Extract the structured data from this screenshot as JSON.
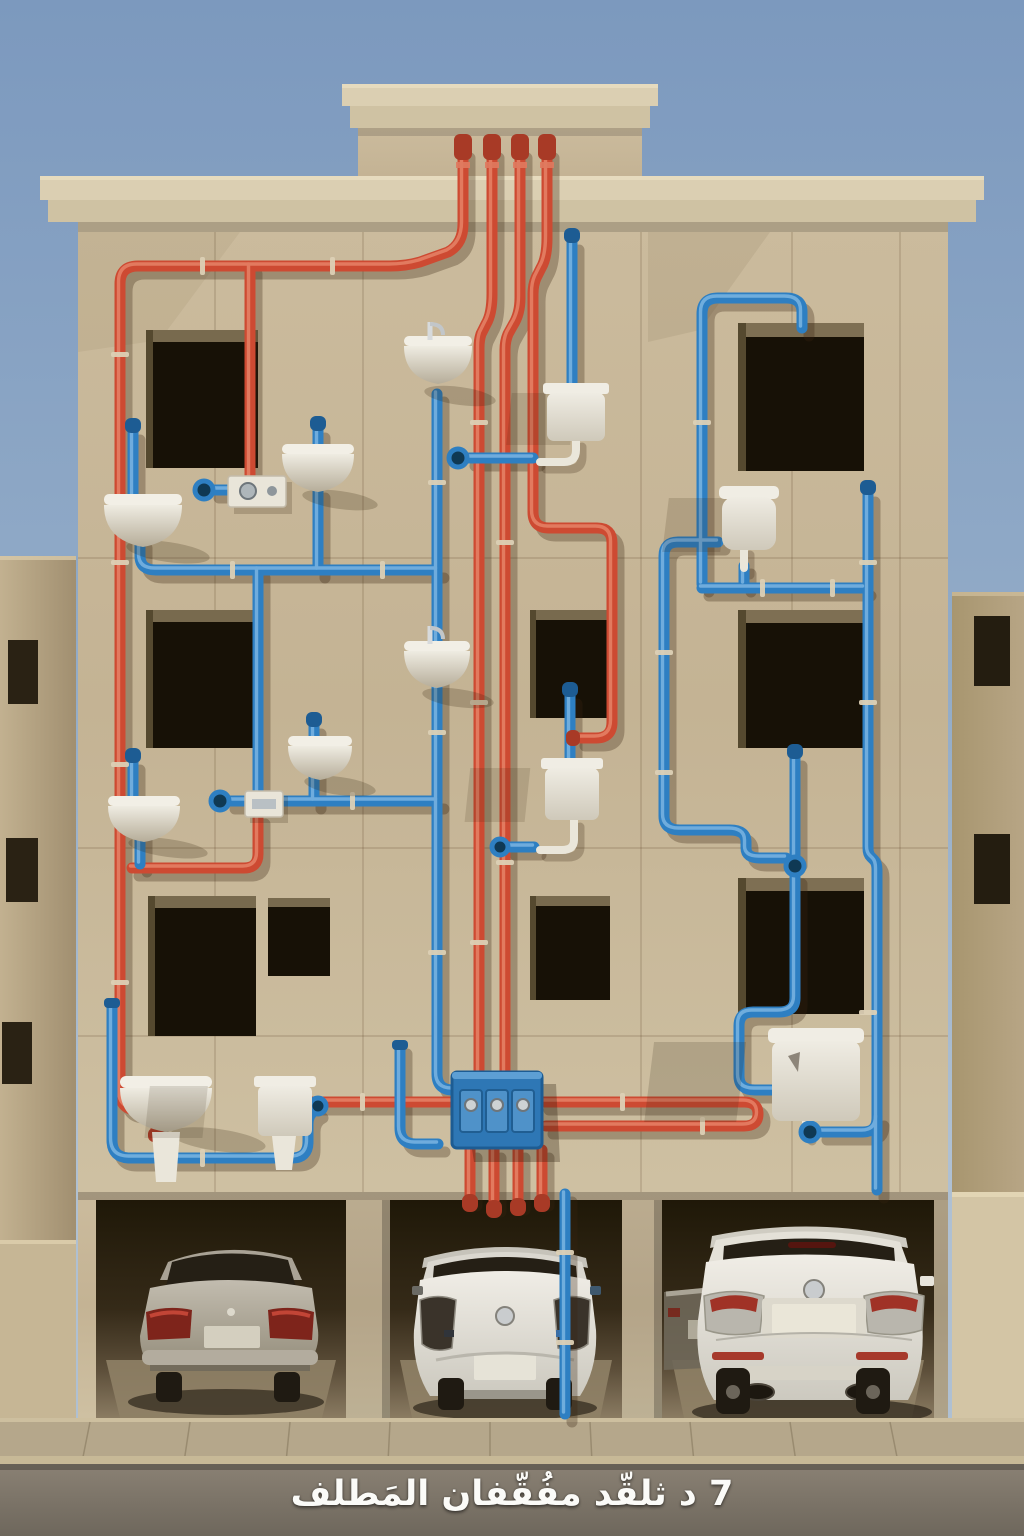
{
  "image": {
    "kind": "photorealistic building facade with exposed color-coded plumbing",
    "width": 1024,
    "height": 1536,
    "time_of_day": "clear daylight"
  },
  "caption": {
    "text": "7 د ثلقّد مفُقّفان المَطلف",
    "dir": "rtl"
  },
  "colors": {
    "sky-top": "#7C99BE",
    "sky-mid": "#93ACC8",
    "sky-bottom": "#AFC0D2",
    "facade": "#C7B797",
    "facade-light": "#D6C8AA",
    "facade-dark": "#B0A081",
    "cornice": "#DBCFB2",
    "cornice-lip": "#CFC2A3",
    "window-dark": "#171106",
    "window-reveal": "#8A7A5C",
    "pipe-hot": "#CD4A32",
    "pipe-hot-light": "#EA8A6F",
    "pipe-hot-dark": "#A83A26",
    "pipe-cold": "#2E7FC2",
    "pipe-cold-light": "#85BCE6",
    "pipe-cold-dark": "#1D5C93",
    "ceramic": "#EAE6DA",
    "ceramic-dark": "#BCB3A0",
    "clamp": "#DCD0B5",
    "manifold": "#2E77B5",
    "manifold-panel": "#4F92C9",
    "neighbor": "#B7A585",
    "neighbor-lit": "#D3C5A5",
    "bay-floor": "#8F8166",
    "sidewalk": "#B5A78B",
    "street": "#827A6D",
    "car-silver": "#B9B3A6",
    "car-white": "#EBE8E1",
    "glass": "#251F15",
    "tire": "#1F1A12",
    "taillight-red": "#A03226",
    "caption-color": "#FBFBF8"
  },
  "building": {
    "floors_above_parking": 3,
    "window_openings": 9,
    "parking_bays": 3,
    "central_tower": true
  },
  "plumbing": {
    "hot_line_label": "hot-water-network",
    "cold_line_label": "cold-water-network",
    "rooftop_risers": 4,
    "manifold_valves": 3,
    "fixtures": {
      "wall_sinks": 7,
      "cisterns": 5,
      "meter_boxes": 2,
      "valve_flanges": 6
    }
  },
  "vehicles": [
    {
      "type": "sedan",
      "color": "silver",
      "bay": 1
    },
    {
      "type": "hatchback",
      "color": "white",
      "bay": 2
    },
    {
      "type": "suv",
      "color": "white",
      "bay": 3
    },
    {
      "type": "sedan",
      "color": "silver",
      "bay": 3,
      "partial": true
    }
  ]
}
